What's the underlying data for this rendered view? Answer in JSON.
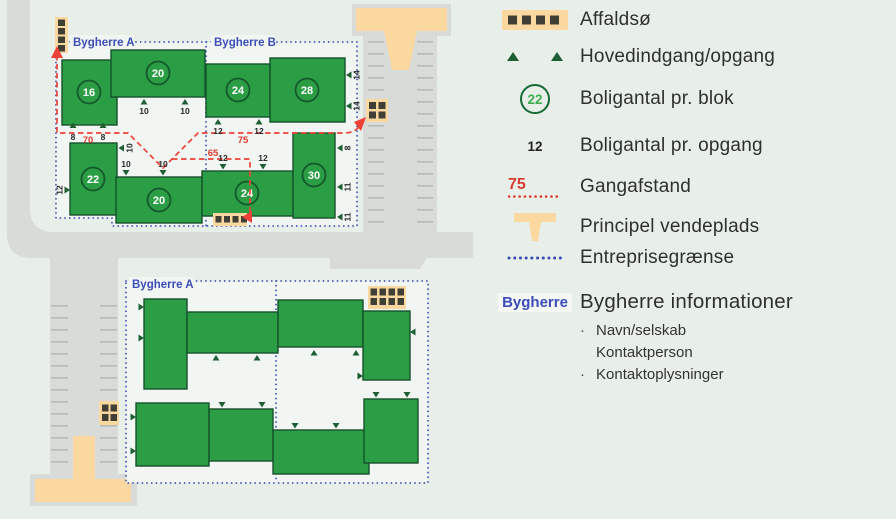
{
  "legend": {
    "affaldso": {
      "label": "Affaldsø"
    },
    "hovedindgang": {
      "label": "Hovedindgang/opgang"
    },
    "boligantal_blok": {
      "label": "Boligantal pr. blok",
      "sample": "22"
    },
    "boligantal_opgang": {
      "label": "Boligantal pr. opgang",
      "sample": "12"
    },
    "gangafstand": {
      "label": "Gangafstand",
      "sample": "75"
    },
    "vendeplads": {
      "label": "Principel vendeplads"
    },
    "entreprisegraense": {
      "label": "Entreprisegrænse"
    },
    "bygherre": {
      "label": "Bygherre informationer",
      "sample": "Bygherre",
      "bullet": "·",
      "lines": [
        "Navn/selskab",
        "Kontaktperson",
        "Kontaktoplysninger"
      ]
    }
  },
  "map": {
    "upper": {
      "label_a": "Bygherre A",
      "label_b": "Bygherre B",
      "blocks": {
        "b16": "16",
        "b20_top": "20",
        "b24_top": "24",
        "b28": "28",
        "b22": "22",
        "b20_bottom": "20",
        "b24_bottom": "24",
        "b30": "30"
      },
      "opgang": {
        "b16": [
          "8",
          "8"
        ],
        "b20_top": [
          "10",
          "10"
        ],
        "b24_top": [
          "12",
          "12"
        ],
        "b28": [
          "14",
          "14"
        ],
        "b22_left": "12",
        "b22_right": "10",
        "b20_bottom": [
          "10",
          "10"
        ],
        "b24_bottom": [
          "12",
          "12"
        ],
        "b30": [
          "8",
          "11",
          "11"
        ]
      },
      "distances": {
        "d70": "70",
        "d75": "75",
        "d65": "65"
      }
    },
    "lower": {
      "label_a": "Bygherre A"
    }
  },
  "colors": {
    "building_green": "#2b9e45",
    "accent_blue": "#3c4db8",
    "accent_red": "#ee4137",
    "vendeplads_tan": "#fbd8a0",
    "road_gray": "#d8dbd8"
  }
}
